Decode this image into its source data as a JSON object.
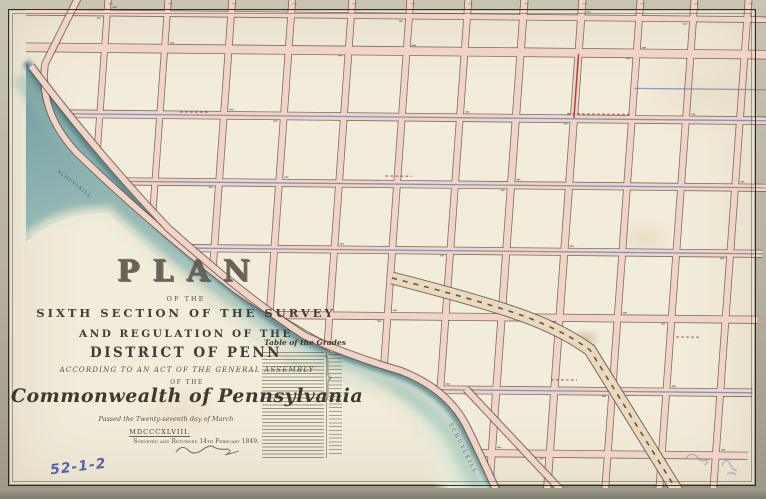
{
  "map": {
    "title_block": {
      "plan": "PLAN",
      "of_the_1": "OF THE",
      "survey_line": "SIXTH SECTION OF THE SURVEY",
      "regulation_line": "AND REGULATION OF THE",
      "district_line": "DISTRICT OF PENN",
      "act_line": "ACCORDING TO AN ACT OF THE GENERAL ASSEMBLY",
      "of_the_2": "OF THE",
      "commonwealth": "Commonwealth of Pennsylvania",
      "passed_line": "Passed the Twenty-seventh day of March",
      "year_line": "MDCCCXLVIII.",
      "surveyed_line": "Surveyed and Returned 14th February 1849."
    },
    "grades_table": {
      "heading": "Table of the Grades",
      "brace": "}"
    },
    "river_labels": {
      "upper": "SCHUYLKILL",
      "lower": "SCHUYLKILL"
    },
    "annotations": {
      "catalog_number": "52-1-2"
    },
    "colors": {
      "paper": "#f2ecda",
      "mat": "#b7b2a0",
      "street_fill": "#f2d4c6",
      "street_outline": "#5a5045",
      "river": "#a6c6bd",
      "river_edge": "#47767f",
      "railroad_fill": "#ead9bd",
      "blue_ink": "#7187bb",
      "red_ink": "#a33327",
      "pencil_blue": "#4257a8",
      "ink": "#433d35"
    }
  }
}
